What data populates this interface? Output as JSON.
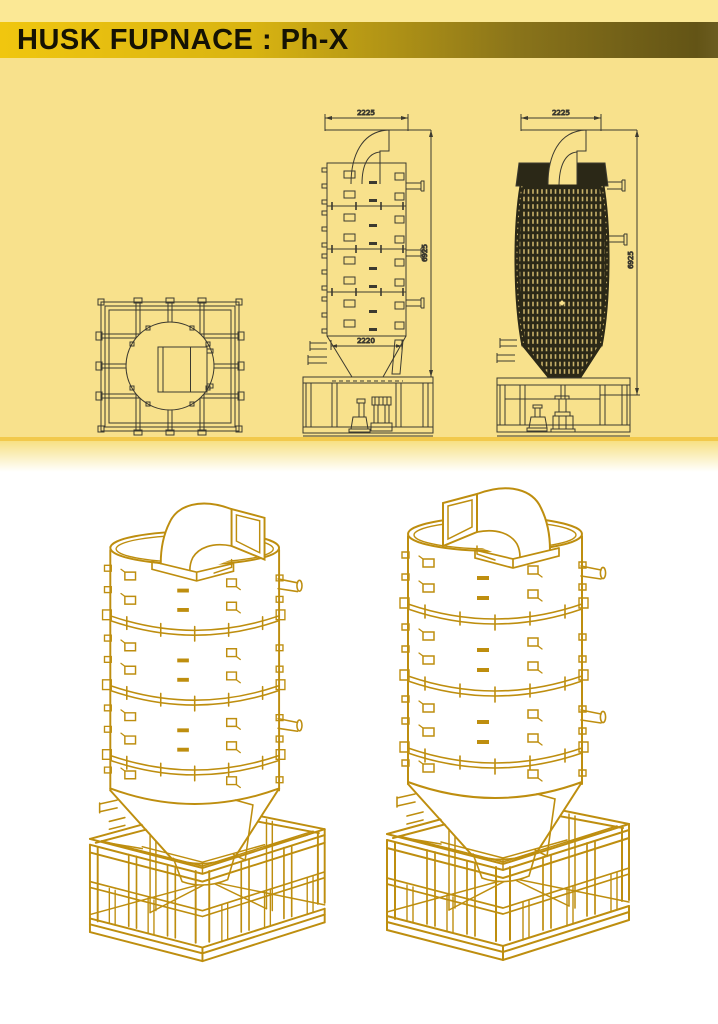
{
  "header": {
    "title": "HUSK FUPNACE : Ph-X"
  },
  "cad": {
    "front_elevation": {
      "top_width": "2225",
      "total_height": "6925",
      "hopper_width": "2220"
    },
    "side_elevation": {
      "top_width": "2225",
      "total_height": "6925"
    }
  },
  "colors": {
    "strip_yellow": "#FBE895",
    "drawing_background": "#F8E18C",
    "header_gradient_start": "#F0C60F",
    "header_gradient_end": "#635416",
    "cad_line": "#3C3A30",
    "dark_fill": "#2B2817",
    "brick_light": "#C9B26A",
    "iso_gold": "#BE8E0F",
    "divider_gold": "#F2C94C"
  }
}
